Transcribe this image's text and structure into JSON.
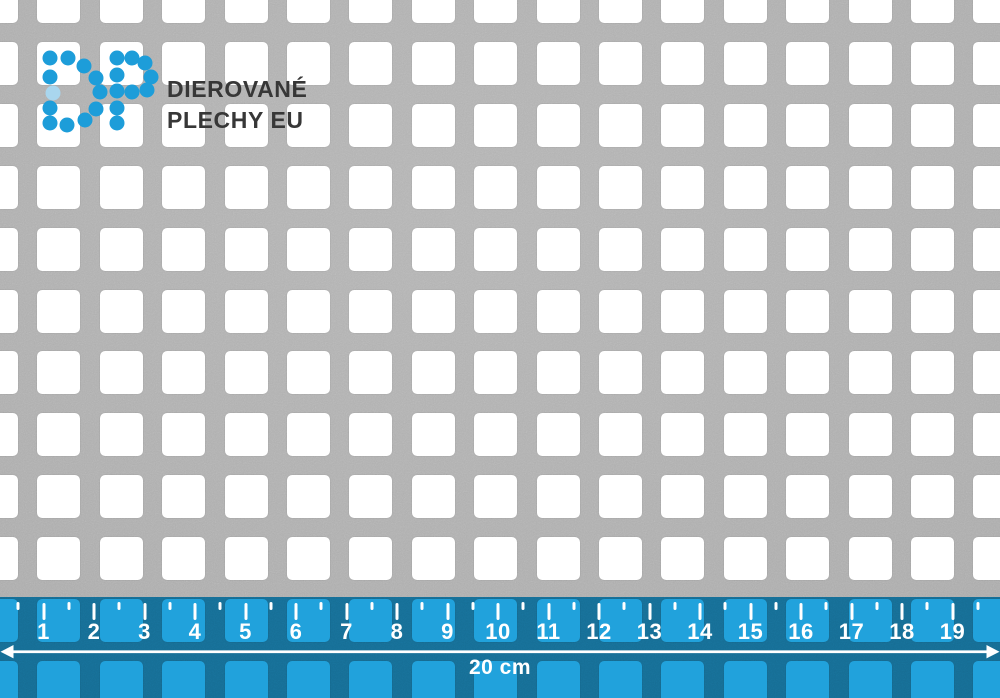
{
  "sheet": {
    "material": "perforated-metal-square-holes",
    "base_color": "#ACACAC",
    "hole_color": "#FFFFFF",
    "pitch_x": 62.4,
    "pitch_y": 61.9,
    "hole_size": 43,
    "corner_radius": 5,
    "offset_x": -25,
    "offset_y": -20,
    "cols": 17,
    "rows": 12
  },
  "logo": {
    "brand_line1": "DIEROVANÉ",
    "brand_line2": "PLECHY EU",
    "text_color": "#373737",
    "dot_color": "#1D9DD9",
    "faint_dot_color": "#A9D6EE",
    "dot_radius": 7.5,
    "dots_d": [
      [
        50,
        58
      ],
      [
        68,
        58
      ],
      [
        84,
        66
      ],
      [
        96,
        78
      ],
      [
        100,
        92
      ],
      [
        96,
        109
      ],
      [
        85,
        120
      ],
      [
        67,
        125
      ],
      [
        50,
        123
      ],
      [
        50,
        108
      ],
      [
        50,
        77
      ]
    ],
    "dots_d_faint": [
      [
        53,
        93
      ]
    ],
    "dots_p": [
      [
        117,
        58
      ],
      [
        117,
        75
      ],
      [
        117,
        91
      ],
      [
        117,
        108
      ],
      [
        117,
        123
      ],
      [
        132,
        58
      ],
      [
        145,
        63
      ],
      [
        151,
        77
      ],
      [
        147,
        90
      ],
      [
        132,
        92
      ]
    ]
  },
  "ruler": {
    "overlay_color": "#21A2DC",
    "top": 597,
    "height": 101,
    "unit_px": 50.5,
    "origin_px": -7,
    "tick_color": "#FFFFFF",
    "labels": [
      "1",
      "2",
      "3",
      "4",
      "5",
      "6",
      "7",
      "8",
      "9",
      "10",
      "11",
      "12",
      "13",
      "14",
      "15",
      "16",
      "17",
      "18",
      "19"
    ],
    "half_ticks_from": 0.5,
    "half_ticks_to": 19.5,
    "arrow_color": "#FFFFFF",
    "total_label": "20 cm"
  }
}
